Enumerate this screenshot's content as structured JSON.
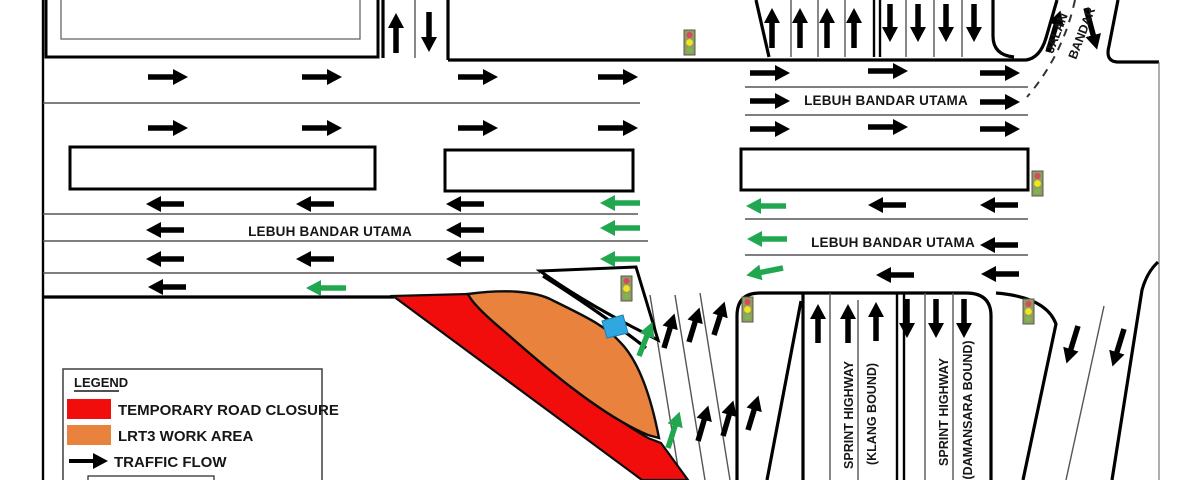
{
  "canvas": {
    "width": 1200,
    "height": 480
  },
  "roads": {
    "lebuh_bandar_utama": "LEBUH BANDAR UTAMA",
    "sprint_highway": "SPRINT HIGHWAY",
    "klang_bound": "(KLANG BOUND)",
    "damansara_bound": "(DAMANSARA BOUND)",
    "jalan_fragment_1": "JALAN",
    "jalan_fragment_2": "BANDAR"
  },
  "legend": {
    "title": "LEGEND",
    "items": [
      {
        "swatch": "red",
        "label": "TEMPORARY ROAD CLOSURE"
      },
      {
        "swatch": "orange",
        "label": "LRT3 WORK AREA"
      },
      {
        "swatch": "arrow",
        "label": "TRAFFIC FLOW"
      }
    ]
  },
  "colors": {
    "closure_red": "#F20D0D",
    "work_area_orange": "#E8823C",
    "reroute_green": "#22A751",
    "flow_black": "#000000",
    "marker_blue": "#2FA8E1",
    "signal_body": "#909C63",
    "signal_red": "#D6495E",
    "signal_yellow": "#F2E51F",
    "signal_green": "#7FB54E"
  },
  "icons": {
    "traffic_light_count": 5
  }
}
